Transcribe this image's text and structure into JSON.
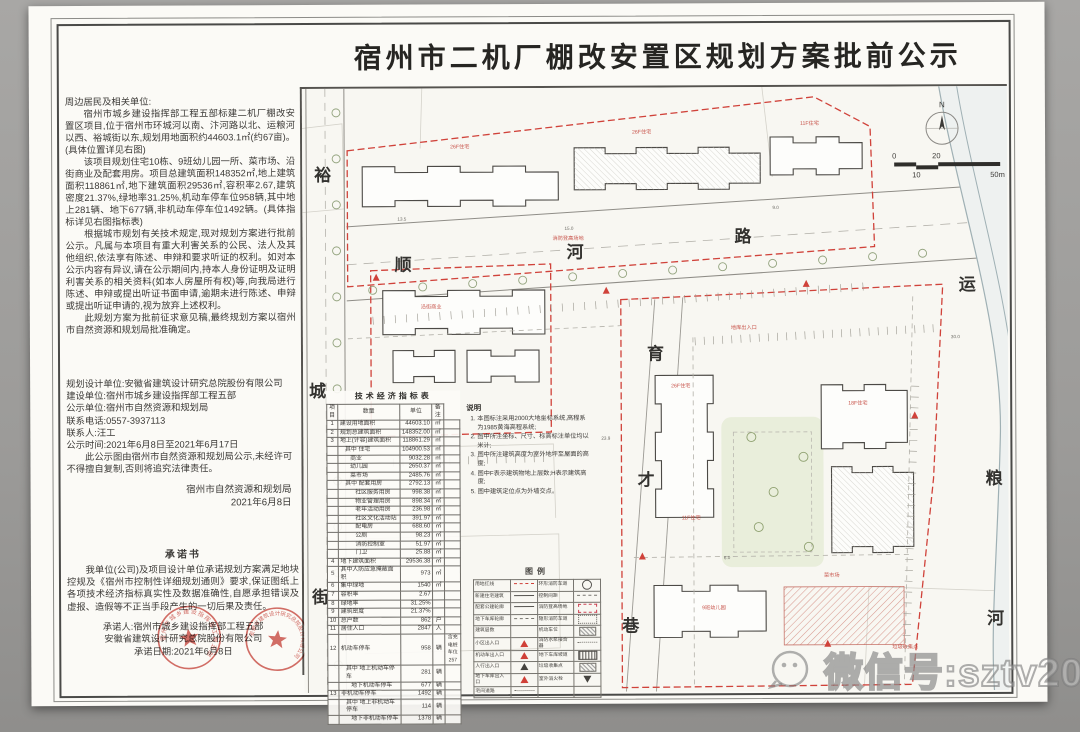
{
  "title": "宿州市二机厂棚改安置区规划方案批前公示",
  "notice": {
    "salutation": "周边居民及相关单位:",
    "paragraphs": [
      "宿州市城乡建设指挥部工程五部标建二机厂棚改安置区项目,位于宿州市环城河以南、汴河路以北、运粮河以西、裕城街以东,规划用地面积约44603.1㎡(约67亩)。(具体位置详见右图)",
      "该项目规划住宅10栋、9班幼儿园一所、菜市场、沿街商业及配套用房。项目总建筑面积148352㎡,地上建筑面积118861㎡,地下建筑面积29536㎡,容积率2.67,建筑密度21.37%,绿地率31.25%,机动车停车位958辆,其中地上281辆、地下677辆,非机动车停车位1492辆。(具体指标详见右图指标表)",
      "根据城市规划有关技术规定,现对规划方案进行批前公示。凡属与本项目有重大利害关系的公民、法人及其他组织,依法享有陈述、申辩和要求听证的权利。如对本公示内容有异议,请在公示期间内,持本人身份证明及证明利害关系的相关资料(如本人房屋所有权)等,向我局进行陈述、申辩或提出听证书面申请,逾期未进行陈述、申辩或提出听证申请的,视为放弃上述权利。",
      "此规划方案为批前征求意见稿,最终规划方案以宿州市自然资源和规划局批准确定。"
    ]
  },
  "info": {
    "lines": [
      "规划设计单位:安徽省建筑设计研究总院股份有限公司",
      "建设单位:宿州市城乡建设指挥部工程五部",
      "公示单位:宿州市自然资源和规划局",
      "联系电话:0557-3937113",
      "联系人:汪工",
      "公示时间:2021年6月8日至2021年6月17日"
    ],
    "disclaimer": "此公示图由宿州市自然资源和规划局公示,未经许可不得擅自复制,否则将追究法律责任。",
    "agency": "宿州市自然资源和规划局",
    "date": "2021年6月8日"
  },
  "commitment": {
    "title": "承诺书",
    "body": "我单位(公司)及项目设计单位承诺规划方案满足地块控规及《宿州市控制性详细规划通则》要求,保证图纸上各项技术经济指标真实性及数据准确性,自愿承担错误及虚报、造假等不正当手段产生的一切后果及责任。",
    "committer1": "承诺人:宿州市城乡建设指挥部工程五部",
    "committer2": "安徽省建筑设计研究总院股份有限公司",
    "date_line": "承诺日期:2021年6月8日",
    "stamp1": "宿州市城乡建设指挥部工程五部",
    "stamp2": "安徽省建筑设计研究总院股份有限公司",
    "stamp_color": "#c8423a"
  },
  "table": {
    "title": "技术经济指标表",
    "headers": [
      "项目",
      "数量",
      "单位",
      "备注"
    ],
    "rows": [
      {
        "no": "1",
        "item": "建设用地面积",
        "value": "44603.10",
        "unit": "㎡",
        "note": ""
      },
      {
        "no": "2",
        "item": "规划总建筑面积",
        "value": "148352.00",
        "unit": "㎡",
        "note": ""
      },
      {
        "no": "3",
        "item": "地上(计容)建筑面积",
        "value": "118861.29",
        "unit": "㎡",
        "note": ""
      },
      {
        "no": "",
        "item": "其中 住宅",
        "value": "104900.53",
        "unit": "㎡",
        "note": "",
        "indent": 1
      },
      {
        "no": "",
        "item": "商业",
        "value": "9032.28",
        "unit": "㎡",
        "note": "",
        "indent": 2
      },
      {
        "no": "",
        "item": "幼儿园",
        "value": "2650.37",
        "unit": "㎡",
        "note": "",
        "indent": 2
      },
      {
        "no": "",
        "item": "菜市场",
        "value": "2485.76",
        "unit": "㎡",
        "note": "",
        "indent": 2
      },
      {
        "no": "",
        "item": "其中 配套用房",
        "value": "2792.13",
        "unit": "㎡",
        "note": "",
        "indent": 1
      },
      {
        "no": "",
        "item": "社区服务用房",
        "value": "998.38",
        "unit": "㎡",
        "note": "",
        "indent": 3
      },
      {
        "no": "",
        "item": "物业管理用房",
        "value": "898.34",
        "unit": "㎡",
        "note": "",
        "indent": 3
      },
      {
        "no": "",
        "item": "老年活动用房",
        "value": "236.98",
        "unit": "㎡",
        "note": "",
        "indent": 3
      },
      {
        "no": "",
        "item": "社区文化活动站",
        "value": "391.97",
        "unit": "㎡",
        "note": "",
        "indent": 3
      },
      {
        "no": "",
        "item": "配电房",
        "value": "688.60",
        "unit": "㎡",
        "note": "",
        "indent": 3
      },
      {
        "no": "",
        "item": "公厕",
        "value": "98.23",
        "unit": "㎡",
        "note": "",
        "indent": 3
      },
      {
        "no": "",
        "item": "消防控制室",
        "value": "51.97",
        "unit": "㎡",
        "note": "",
        "indent": 3
      },
      {
        "no": "",
        "item": "门卫",
        "value": "25.88",
        "unit": "㎡",
        "note": "",
        "indent": 3
      },
      {
        "no": "4",
        "item": "地下建筑面积",
        "value": "29536.38",
        "unit": "㎡",
        "note": ""
      },
      {
        "no": "5",
        "item": "其中人防应急掩蔽面积",
        "value": "973",
        "unit": "㎡",
        "note": ""
      },
      {
        "no": "6",
        "item": "集中绿地",
        "value": "1540",
        "unit": "㎡",
        "note": ""
      },
      {
        "no": "7",
        "item": "容积率",
        "value": "2.67",
        "unit": "",
        "note": ""
      },
      {
        "no": "8",
        "item": "绿地率",
        "value": "31.25%",
        "unit": "",
        "note": ""
      },
      {
        "no": "9",
        "item": "建筑密度",
        "value": "21.37%",
        "unit": "",
        "note": ""
      },
      {
        "no": "10",
        "item": "总户数",
        "value": "862",
        "unit": "户",
        "note": ""
      },
      {
        "no": "11",
        "item": "居住人口",
        "value": "2847",
        "unit": "人",
        "note": ""
      },
      {
        "no": "12",
        "item": "机动车停车",
        "value": "958",
        "unit": "辆",
        "note": "含充电桩车位257"
      },
      {
        "no": "",
        "item": "其中 地上机动车停车",
        "value": "281",
        "unit": "辆",
        "note": "",
        "indent": 1
      },
      {
        "no": "",
        "item": "地下机动车停车",
        "value": "677",
        "unit": "辆",
        "note": "",
        "indent": 2
      },
      {
        "no": "13",
        "item": "非机动车停车",
        "value": "1492",
        "unit": "辆",
        "note": ""
      },
      {
        "no": "",
        "item": "其中 地上非机动车停车",
        "value": "114",
        "unit": "辆",
        "note": "",
        "indent": 1
      },
      {
        "no": "",
        "item": "地下非机动车停车",
        "value": "1378",
        "unit": "辆",
        "note": "",
        "indent": 2
      }
    ]
  },
  "notes": {
    "title": "说明",
    "items": [
      "本图标注采用2000大地坐标系统,高程系为1985黄海高程系统;",
      "图中所注坐标、尺寸、标高标注单位均以米计;",
      "图中所注建筑高度为室外地坪至屋面的高度;",
      "图中F表示建筑物地上层数;H表示建筑高度;",
      "图中建筑定位点为外墙交点。"
    ]
  },
  "legend": {
    "title": "图例",
    "left": [
      {
        "label": "用地红线",
        "sym": "reddash"
      },
      {
        "label": "新建住宅建筑",
        "sym": "line"
      },
      {
        "label": "配套公建轮廓",
        "sym": "line"
      },
      {
        "label": "地下车库轮廓",
        "sym": "dash"
      },
      {
        "label": "建筑层数",
        "sym": "blank"
      },
      {
        "label": "小区出入口",
        "sym": "trired"
      },
      {
        "label": "机动车出入口",
        "sym": "trired"
      },
      {
        "label": "人行出入口",
        "sym": "tri"
      },
      {
        "label": "地下车库出入口",
        "sym": "trired"
      },
      {
        "label": "宅间道路",
        "sym": "dot"
      }
    ],
    "right": [
      {
        "label": "环形消防车道",
        "sym": "circle"
      },
      {
        "label": "控制间距",
        "sym": "dash"
      },
      {
        "label": "消防登高场地",
        "sym": "dashrect"
      },
      {
        "label": "隐形消防车道",
        "sym": "dotrect"
      },
      {
        "label": "机动车位",
        "sym": "hatch"
      },
      {
        "label": "消防水泵接合器",
        "sym": "dot"
      },
      {
        "label": "地下车库坡道",
        "sym": "ramp"
      },
      {
        "label": "垃圾收集点",
        "sym": "hatch"
      },
      {
        "label": "室外消火栓",
        "sym": "tridown"
      },
      {
        "label": "",
        "sym": "blank"
      }
    ]
  },
  "map": {
    "roads": {
      "west_chars": [
        "裕",
        "城",
        "街"
      ],
      "north_chars": [
        "顺",
        "河",
        "路"
      ],
      "east_chars": [
        "运",
        "粮",
        "河"
      ],
      "mid_chars": [
        "育",
        "才",
        "巷"
      ]
    },
    "north_label": "N",
    "scale_labels": [
      "0",
      "10",
      "20",
      "50m"
    ],
    "annotations": [
      "26F住宅",
      "26F住宅",
      "11F住宅",
      "沿街商业",
      "26F住宅",
      "18F住宅",
      "11F住宅",
      "9班幼儿园",
      "菜市场",
      "地库出入口",
      "消防登高场地",
      "垃圾收集点"
    ],
    "dims": [
      "13.5",
      "15.0",
      "9.0",
      "23.9",
      "30.0",
      "6.0"
    ],
    "boundary_color": "#d0423a"
  },
  "watermark": {
    "text": "微信号:sztv2013"
  }
}
